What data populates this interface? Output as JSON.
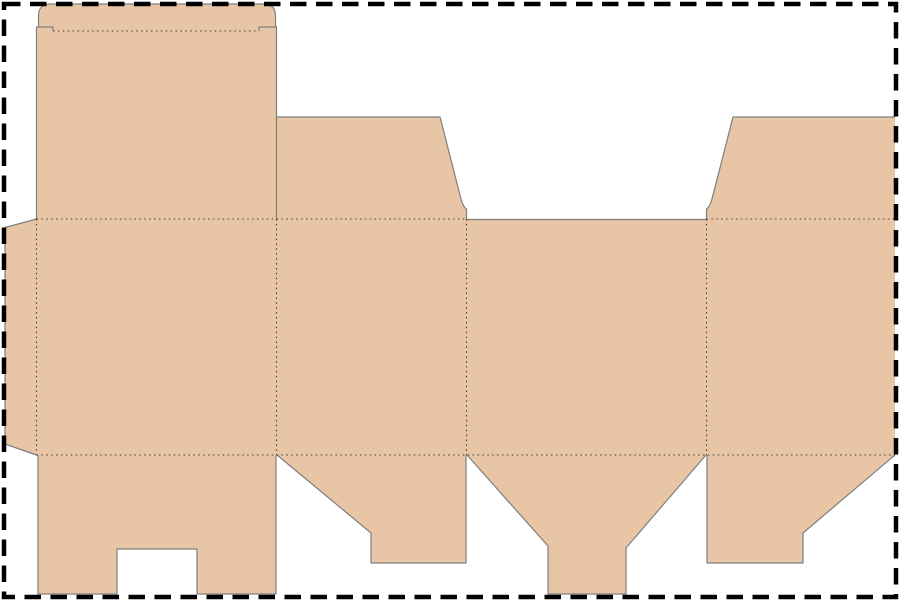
{
  "colors": {
    "background": "#ffffff",
    "board_fill": "#e8c5a4",
    "cut_line": "#7f7f7f",
    "fold_line": "#3f3f3f",
    "sheet_border": "#000000"
  },
  "geometry": {
    "board_fill": "M36.5,219 V27 H38.5 V16 Q38.5,4 50.5,4 H263.5 Q275.5,4 275.5,16 V27 H276.5 V219 Z M36.5,219 H895 V455 H36.5 Z M276.5,219 V117 H440 L460.5,197 Q463,207 466.5,209 V219 Z M895,219 V117 H733 L712.5,197 Q710,207 706.5,209 V219 Z M36.5,219 L5,227.5 V444 L36.5,455 Z M38,455 V594 H117 V549 H197 V594 H276 V455 Z M277,455 L371,533 V563 H466 V455 Z M467,455 H706 L626,548 V594 H548 V546 Z M707,455 V563 H803 V533 L895,455 Z",
    "cut_lines": "M36.5,219 V27 H38.5 V16 Q38.5,4 50.5,4 H263.5 Q275.5,4 275.5,16 V27 H276.5 V219 M38.5,27 H53 V31 M275.5,27 H259 V31 M276.5,117 H440 L460.5,197 Q463,207 466.5,209 V219 M466.5,219.5 H706.5 M706.5,219 V209 Q710,207 712.5,197 L733,117 H895 M36.5,219 L5,227.5 V444 L36.5,455 M38,455 V594 H117 V549 H197 V594 H276 V455 M277,455 L371,533 V563 H466 V455 M467,455 L548,546 V594 H626 V548 L706,455 M707,455 V563 H803 V533 L895,455",
    "fold_lines": "M53,31 H259 M36.5,219 H466.5 M706.5,219 H895 M36.5,455 H895 M36.5,219 V455 M276.5,219 V455 M466.5,219 V455 M706.5,219 V455",
    "sheet_border": "M4,4 H896 V597 H4 Z"
  }
}
